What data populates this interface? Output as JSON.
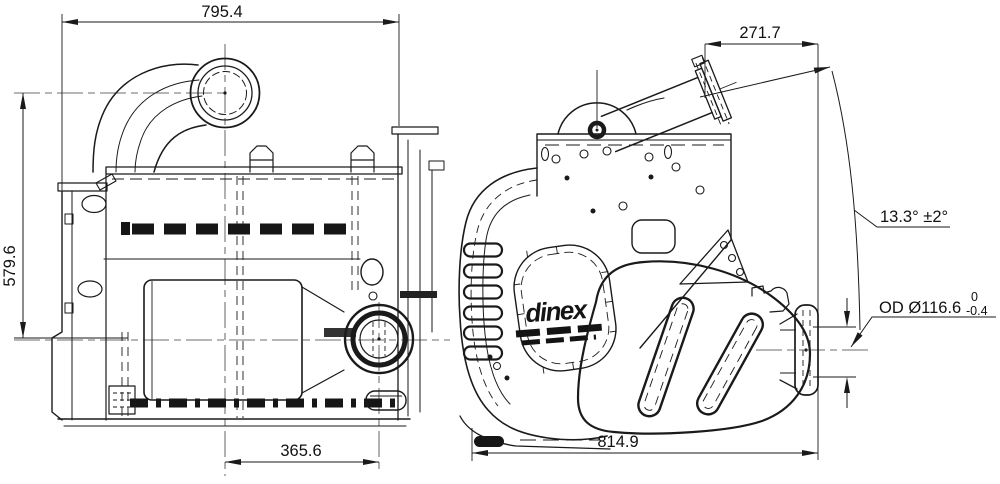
{
  "logo": {
    "brand": "dinex"
  },
  "dimensions": {
    "front_overall_width": "795.4",
    "front_overall_height": "579.6",
    "front_inlet_to_outlet_centers": "365.6",
    "side_inlet_offset": "271.7",
    "side_inlet_angle": "13.3° ±2°",
    "side_overall_length": "814.9",
    "outlet_od_label": "OD Ø116.6",
    "outlet_od_tol_upper": "0",
    "outlet_od_tol_lower": "-0.4"
  },
  "colors": {
    "line": "#1a1a1a",
    "background": "#ffffff"
  }
}
